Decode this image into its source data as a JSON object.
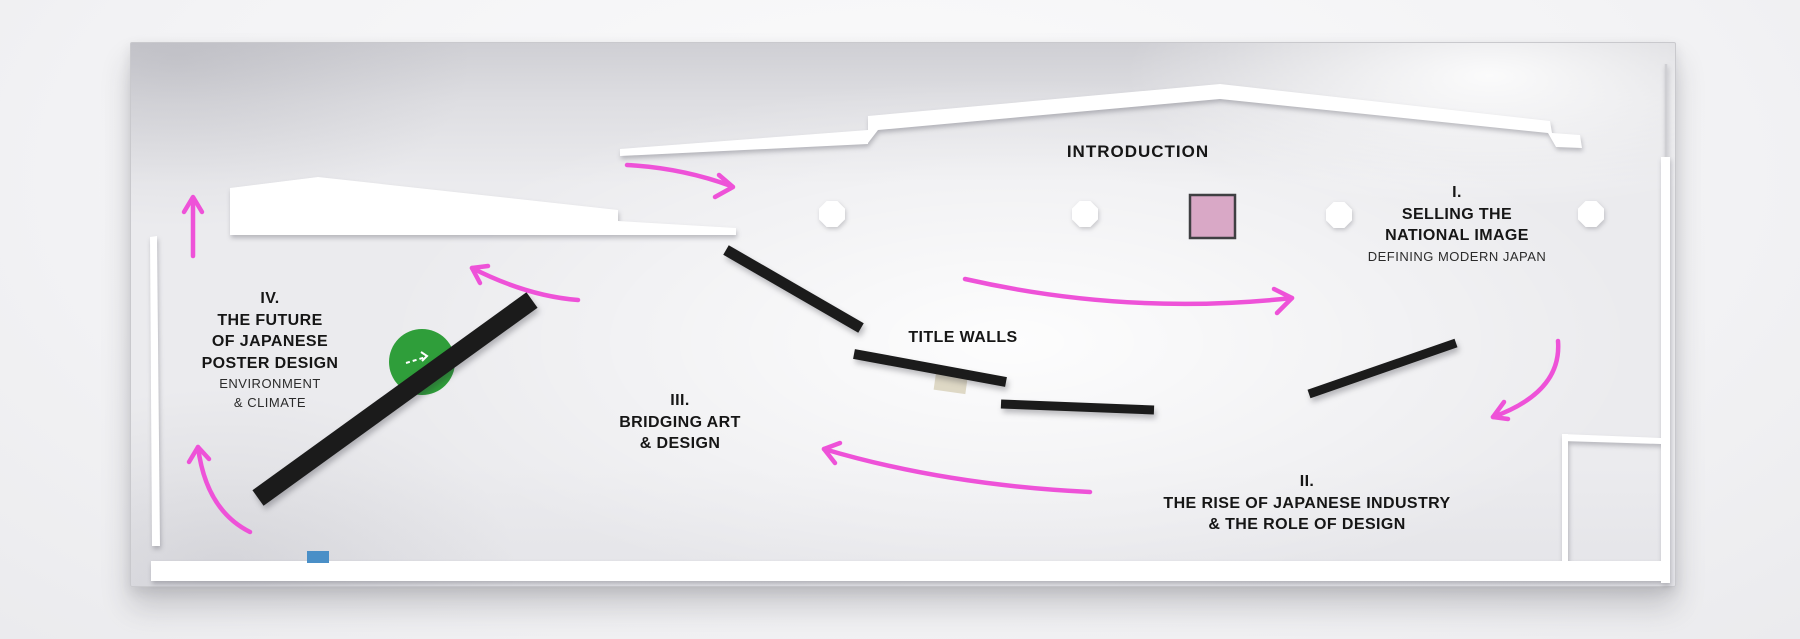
{
  "plan": {
    "intro_label": "INTRODUCTION",
    "title_walls_label": "TITLE WALLS",
    "section1": {
      "number": "I.",
      "line1": "SELLING THE",
      "line2": "NATIONAL IMAGE",
      "subtitle": "DEFINING MODERN JAPAN"
    },
    "section2": {
      "number": "II.",
      "line1": "THE RISE OF JAPANESE INDUSTRY",
      "line2": "& THE ROLE OF DESIGN"
    },
    "section3": {
      "number": "III.",
      "line1": "BRIDGING ART",
      "line2": "& DESIGN"
    },
    "section4": {
      "number": "IV.",
      "line1": "THE FUTURE",
      "line2": "OF JAPANESE",
      "line3": "POSTER DESIGN",
      "subtitle1": "ENVIRONMENT",
      "subtitle2": "& CLIMATE"
    }
  },
  "colors": {
    "arrow": "#ee52d8",
    "wall": "#1b1b1b",
    "white_wall": "#ffffff",
    "pink_square": "#d9a8c6",
    "pink_square_border": "#3f3f42",
    "green_circle": "#2f9e3a",
    "blue_marker": "#4a8fc7",
    "beige_marker": "#ded8c5"
  }
}
